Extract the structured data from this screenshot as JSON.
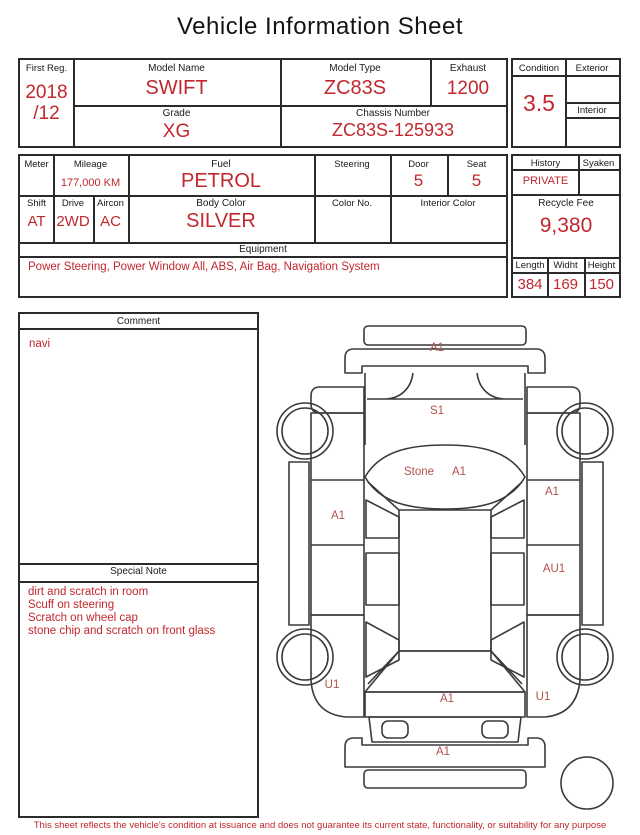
{
  "title": "Vehicle Information Sheet",
  "colors": {
    "value_red": "#c1272d",
    "diagram_label_red": "#b2504a",
    "line_black": "#2b2b2b"
  },
  "vehicle": {
    "first_reg": {
      "label": "First Reg.",
      "value": "2018\n/12"
    },
    "model_name": {
      "label": "Model Name",
      "value": "SWIFT"
    },
    "model_type": {
      "label": "Model Type",
      "value": "ZC83S"
    },
    "exhaust": {
      "label": "Exhaust",
      "value": "1200"
    },
    "grade": {
      "label": "Grade",
      "value": "XG"
    },
    "chassis_number": {
      "label": "Chassis Number",
      "value": "ZC83S-125933"
    },
    "condition": {
      "label": "Condition",
      "value": "3.5"
    },
    "exterior": {
      "label": "Exterior",
      "value": ""
    },
    "interior": {
      "label": "Interior",
      "value": ""
    }
  },
  "specs": {
    "meter": {
      "label": "Meter",
      "value": ""
    },
    "mileage": {
      "label": "Mileage",
      "value": "177,000 KM"
    },
    "fuel": {
      "label": "Fuel",
      "value": "PETROL"
    },
    "steering": {
      "label": "Steering",
      "value": ""
    },
    "door": {
      "label": "Door",
      "value": "5"
    },
    "seat": {
      "label": "Seat",
      "value": "5"
    },
    "shift": {
      "label": "Shift",
      "value": "AT"
    },
    "drive": {
      "label": "Drive",
      "value": "2WD"
    },
    "aircon": {
      "label": "Aircon",
      "value": "AC"
    },
    "body_color": {
      "label": "Body Color",
      "value": "SILVER"
    },
    "color_no": {
      "label": "Color No.",
      "value": ""
    },
    "interior_color": {
      "label": "Interior Color",
      "value": ""
    },
    "equipment": {
      "label": "Equipment",
      "value": "Power Steering, Power Window  All, ABS, Air Bag, Navigation System"
    },
    "history": {
      "label": "History",
      "value": "PRIVATE"
    },
    "syaken": {
      "label": "Syaken",
      "value": ""
    },
    "recycle_fee": {
      "label": "Recycle Fee",
      "value": "9,380"
    },
    "length": {
      "label": "Length",
      "value": "384"
    },
    "width": {
      "label": "Widht",
      "value": "169"
    },
    "height": {
      "label": "Height",
      "value": "150"
    }
  },
  "comment": {
    "label": "Comment",
    "value": "navi"
  },
  "special_note": {
    "label": "Special Note",
    "lines": [
      "dirt and scratch in room",
      "Scuff on steering",
      "Scratch on wheel cap",
      "stone chip and scratch on front glass"
    ]
  },
  "diagram": {
    "labels": [
      {
        "code": "A1",
        "part": "front bumper"
      },
      {
        "code": "S1",
        "part": "hood"
      },
      {
        "code": "Stone",
        "part": "windshield"
      },
      {
        "code": "A1",
        "part": "windshield"
      },
      {
        "code": "A1",
        "part": "left front door"
      },
      {
        "code": "A1",
        "part": "right front door"
      },
      {
        "code": "AU1",
        "part": "right rear door"
      },
      {
        "code": "U1",
        "part": "left rear fender"
      },
      {
        "code": "U1",
        "part": "right rear fender"
      },
      {
        "code": "A1",
        "part": "tailgate"
      },
      {
        "code": "A1",
        "part": "rear bumper"
      }
    ]
  },
  "footer": "This sheet reflects the vehicle's condition at issuance and does not guarantee its current state, functionality, or suitability for any purpose"
}
